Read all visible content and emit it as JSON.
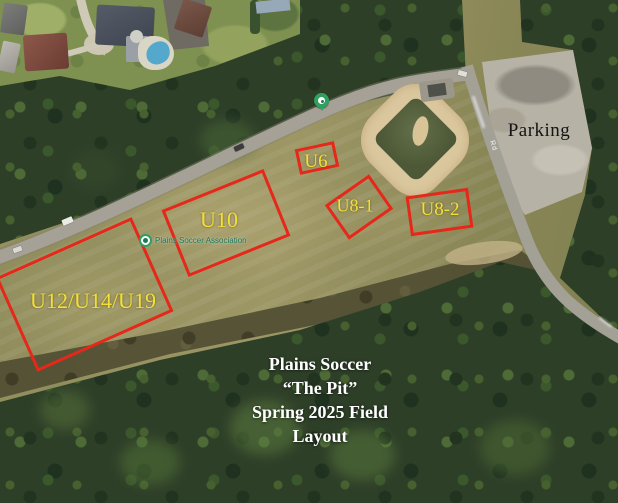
{
  "map_overlay": {
    "fields": [
      {
        "id": "u12_u14_u19",
        "label": "U12/U14/U19"
      },
      {
        "id": "u10",
        "label": "U10"
      },
      {
        "id": "u6",
        "label": "U6"
      },
      {
        "id": "u8_1",
        "label": "U8-1"
      },
      {
        "id": "u8_2",
        "label": "U8-2"
      }
    ],
    "parking_label": "Parking",
    "title_lines": [
      "Plains Soccer",
      "“The Pit”",
      "Spring 2025 Field",
      "Layout"
    ]
  },
  "map_base": {
    "poi_name": "Plains Soccer Association",
    "road_label": "Rd"
  },
  "colors": {
    "field_outline": "#e6281b",
    "field_label_text": "#f2e03a",
    "overlay_title_text": "#ffffff",
    "parking_text": "#141414",
    "poi_text": "#19775b",
    "pin_green": "#2fa05e"
  }
}
